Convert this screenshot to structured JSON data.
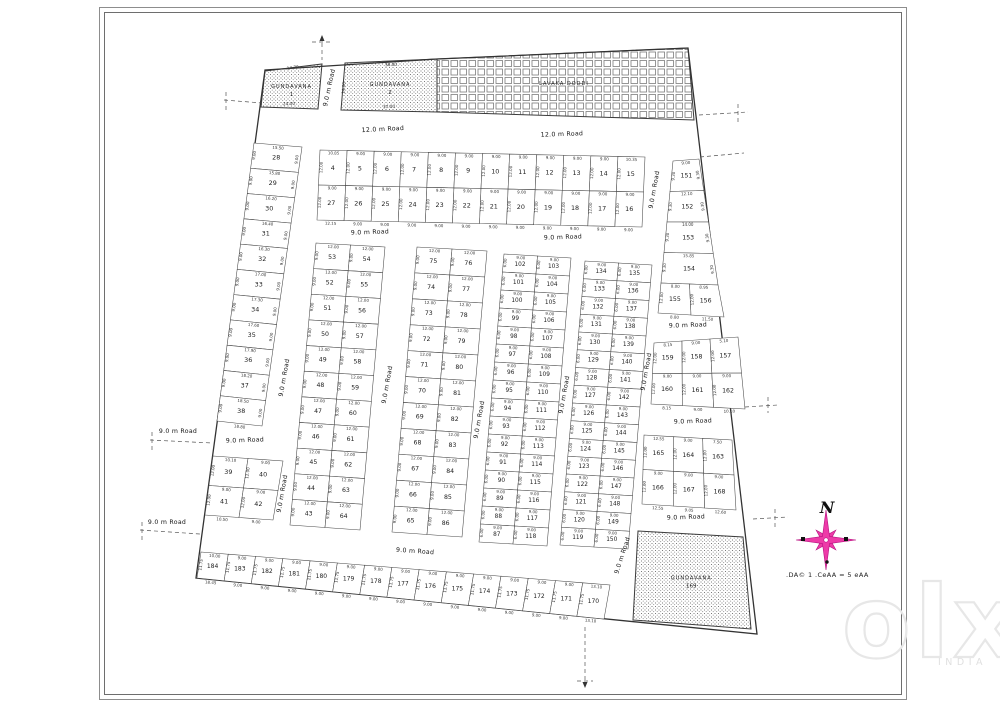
{
  "north": {
    "label": "N"
  },
  "scale_text": ".DA© 1  .CeAA = 5 eAA",
  "watermark": {
    "brand": "olx",
    "region": "INDIA"
  },
  "layout": {
    "boundary": [
      [
        265,
        70
      ],
      [
        437,
        59
      ],
      [
        688,
        48
      ],
      [
        757,
        634
      ],
      [
        196,
        578
      ]
    ],
    "special_areas": [
      {
        "name": "area-gundavana-1",
        "label": "GUNDAVANA",
        "number": "1",
        "pattern": "stipple",
        "poly": [
          [
            265,
            71
          ],
          [
            322,
            64
          ],
          [
            318,
            109
          ],
          [
            261,
            107
          ]
        ],
        "dims": [
          {
            "t": "14.70",
            "x": 293,
            "y": 69,
            "r": -7
          },
          {
            "t": "24.00",
            "x": 289,
            "y": 105,
            "r": -2
          }
        ]
      },
      {
        "name": "area-gundavana-2",
        "label": "GUNDAVANA",
        "number": "2",
        "pattern": "stipple",
        "poly": [
          [
            345,
            63
          ],
          [
            437,
            59
          ],
          [
            437,
            112
          ],
          [
            341,
            110
          ]
        ],
        "dims": [
          {
            "t": "36.00",
            "x": 391,
            "y": 66,
            "r": -2
          },
          {
            "t": "37.00",
            "x": 389,
            "y": 108,
            "r": -2
          },
          {
            "t": "14.00",
            "x": 345,
            "y": 88,
            "r": -85
          }
        ]
      },
      {
        "name": "area-lavaka-doddi",
        "label": "LAVAKA DODDI",
        "number": "",
        "pattern": "gridhatch",
        "poly": [
          [
            437,
            59
          ],
          [
            688,
            48
          ],
          [
            694,
            120
          ],
          [
            437,
            112
          ]
        ],
        "dims": []
      },
      {
        "name": "area-gundavana-169",
        "label": "GUNDAVANA",
        "number": "169",
        "pattern": "stipple",
        "poly": [
          [
            638,
            531
          ],
          [
            743,
            537
          ],
          [
            751,
            629
          ],
          [
            633,
            620
          ]
        ],
        "dims": []
      }
    ],
    "blocks": [
      {
        "name": "block-4-27",
        "quad": [
          [
            320,
            150
          ],
          [
            645,
            157
          ],
          [
            642,
            227
          ],
          [
            317,
            220
          ]
        ],
        "rows": 2,
        "cols": 12,
        "fs": 6.4,
        "nums": [
          [
            4,
            5,
            6,
            7,
            8,
            9,
            10,
            11,
            12,
            13,
            14,
            15
          ],
          [
            27,
            26,
            25,
            24,
            23,
            22,
            21,
            20,
            19,
            18,
            17,
            16
          ]
        ],
        "wdim": "9.00",
        "ddim": "12.00",
        "top_dims": [
          "10.85",
          "9.00",
          "9.00",
          "9.00",
          "9.00",
          "9.00",
          "9.00",
          "9.00",
          "9.00",
          "9.00",
          "9.00",
          "10.35"
        ],
        "bottom_dims": [
          "12.15",
          "9.00",
          "9.00",
          "9.00",
          "9.00",
          "9.00",
          "9.00",
          "9.00",
          "9.00",
          "9.00",
          "9.00",
          "9.00"
        ]
      },
      {
        "name": "block-28-38",
        "quad": [
          [
            254,
            143
          ],
          [
            302,
            147
          ],
          [
            262,
            426
          ],
          [
            217,
            421
          ]
        ],
        "rows": 11,
        "cols": 1,
        "fs": 6.4,
        "nums": [
          [
            28
          ],
          [
            29
          ],
          [
            30
          ],
          [
            31
          ],
          [
            32
          ],
          [
            33
          ],
          [
            34
          ],
          [
            35
          ],
          [
            36
          ],
          [
            37
          ],
          [
            38
          ]
        ],
        "ddim": "9.00",
        "ddim_right": "9.00",
        "row_dims": [
          "15.50",
          "15.80",
          "16.20",
          "16.40",
          "16.30",
          "17.00",
          "17.30",
          "17.60",
          "17.90",
          "18.20",
          "18.50"
        ],
        "bottom_dims": [
          "18.80"
        ]
      },
      {
        "name": "block-39-42",
        "quad": [
          [
            213,
            456
          ],
          [
            283,
            461
          ],
          [
            273,
            520
          ],
          [
            205,
            515
          ]
        ],
        "rows": 2,
        "cols": 2,
        "fs": 6.4,
        "nums": [
          [
            39,
            40
          ],
          [
            41,
            42
          ]
        ],
        "wdim": "9.00",
        "ddim": "12.00",
        "top_dims": [
          "10.10",
          "9.00"
        ],
        "bottom_dims": [
          "10.50",
          "9.00"
        ]
      },
      {
        "name": "block-43-64",
        "quad": [
          [
            316,
            243
          ],
          [
            385,
            247
          ],
          [
            360,
            530
          ],
          [
            290,
            525
          ]
        ],
        "rows": 11,
        "cols": 2,
        "fs": 6.2,
        "nums": [
          [
            53,
            54
          ],
          [
            52,
            55
          ],
          [
            51,
            56
          ],
          [
            50,
            57
          ],
          [
            49,
            58
          ],
          [
            48,
            59
          ],
          [
            47,
            60
          ],
          [
            46,
            61
          ],
          [
            45,
            62
          ],
          [
            44,
            63
          ],
          [
            43,
            64
          ]
        ],
        "wdim": "12.00",
        "ddim": "9.00"
      },
      {
        "name": "block-65-86",
        "quad": [
          [
            417,
            247
          ],
          [
            487,
            251
          ],
          [
            462,
            537
          ],
          [
            392,
            532
          ]
        ],
        "rows": 11,
        "cols": 2,
        "fs": 6.2,
        "nums": [
          [
            75,
            76
          ],
          [
            74,
            77
          ],
          [
            73,
            78
          ],
          [
            72,
            79
          ],
          [
            71,
            80
          ],
          [
            70,
            81
          ],
          [
            69,
            82
          ],
          [
            68,
            83
          ],
          [
            67,
            84
          ],
          [
            66,
            85
          ],
          [
            65,
            86
          ]
        ],
        "wdim": "12.00",
        "ddim": "9.00"
      },
      {
        "name": "block-87-118",
        "quad": [
          [
            504,
            254
          ],
          [
            571,
            258
          ],
          [
            547,
            546
          ],
          [
            479,
            542
          ]
        ],
        "rows": 16,
        "cols": 2,
        "fs": 5.8,
        "nums": [
          [
            102,
            103
          ],
          [
            101,
            104
          ],
          [
            100,
            105
          ],
          [
            99,
            106
          ],
          [
            98,
            107
          ],
          [
            97,
            108
          ],
          [
            96,
            109
          ],
          [
            95,
            110
          ],
          [
            94,
            111
          ],
          [
            93,
            112
          ],
          [
            92,
            113
          ],
          [
            91,
            114
          ],
          [
            90,
            115
          ],
          [
            89,
            116
          ],
          [
            88,
            117
          ],
          [
            87,
            118
          ]
        ],
        "wdim": "9.00",
        "ddim": "6.00"
      },
      {
        "name": "block-119-150",
        "quad": [
          [
            585,
            261
          ],
          [
            652,
            265
          ],
          [
            628,
            549
          ],
          [
            560,
            545
          ]
        ],
        "rows": 16,
        "cols": 2,
        "fs": 5.8,
        "nums": [
          [
            134,
            135
          ],
          [
            133,
            136
          ],
          [
            132,
            137
          ],
          [
            131,
            138
          ],
          [
            130,
            139
          ],
          [
            129,
            140
          ],
          [
            128,
            141
          ],
          [
            127,
            142
          ],
          [
            126,
            143
          ],
          [
            125,
            144
          ],
          [
            124,
            145
          ],
          [
            123,
            146
          ],
          [
            122,
            147
          ],
          [
            121,
            148
          ],
          [
            120,
            149
          ],
          [
            119,
            150
          ]
        ],
        "wdim": "9.00",
        "ddim": "6.00"
      },
      {
        "name": "block-151-154",
        "quad": [
          [
            673,
            161
          ],
          [
            699,
            159
          ],
          [
            718,
            285
          ],
          [
            661,
            283
          ]
        ],
        "rows": 4,
        "cols": 1,
        "fs": 6.2,
        "nums": [
          [
            151
          ],
          [
            152
          ],
          [
            153
          ],
          [
            154
          ]
        ],
        "ddim": "9.30",
        "ddim_right": "9.30",
        "row_dims": [
          "9.00",
          "12.10",
          "14.00",
          "15.85"
        ],
        "bottom_dims": [
          "17.75"
        ]
      },
      {
        "name": "block-155-156",
        "quad": [
          [
            661,
            283
          ],
          [
            718,
            285
          ],
          [
            724,
            317
          ],
          [
            658,
            313
          ]
        ],
        "rows": 1,
        "cols": 2,
        "fs": 6.2,
        "nums": [
          [
            155,
            156
          ]
        ],
        "ddim": "12.00",
        "top_dims": [
          "8.00",
          "8.95"
        ],
        "bottom_dims": [
          "8.80",
          "11.50"
        ]
      },
      {
        "name": "block-157-162",
        "quad": [
          [
            654,
            343
          ],
          [
            738,
            337
          ],
          [
            745,
            409
          ],
          [
            651,
            404
          ]
        ],
        "rows": 2,
        "cols": 3,
        "fs": 6.2,
        "nums": [
          [
            159,
            158,
            157
          ],
          [
            160,
            161,
            162
          ]
        ],
        "wdim": "9.00",
        "ddim": "12.00",
        "top_dims": [
          "8.15",
          "9.00",
          "5.10"
        ],
        "bottom_dims": [
          "8.15",
          "9.00",
          "10.10"
        ]
      },
      {
        "name": "block-163-168",
        "quad": [
          [
            644,
            435
          ],
          [
            732,
            440
          ],
          [
            736,
            510
          ],
          [
            642,
            504
          ]
        ],
        "rows": 2,
        "cols": 3,
        "fs": 6.2,
        "nums": [
          [
            165,
            164,
            163
          ],
          [
            166,
            167,
            168
          ]
        ],
        "wdim": "9.00",
        "ddim": "12.00",
        "top_dims": [
          "12.55",
          "9.00",
          "7.50"
        ],
        "bottom_dims": [
          "12.55",
          "9.05",
          "12.60"
        ]
      },
      {
        "name": "block-170-184",
        "quad": [
          [
            201,
            552
          ],
          [
            610,
            585
          ],
          [
            604,
            619
          ],
          [
            197,
            578
          ]
        ],
        "rows": 1,
        "cols": 15,
        "fs": 6.0,
        "nums": [
          [
            184,
            183,
            182,
            181,
            180,
            179,
            178,
            177,
            176,
            175,
            174,
            173,
            172,
            171,
            170
          ]
        ],
        "wdim": "9.00",
        "ddim": "11.75",
        "top_dims": [
          "10.00",
          "9.00",
          "9.00",
          "9.00",
          "9.00",
          "9.00",
          "9.00",
          "9.00",
          "9.00",
          "9.00",
          "9.00",
          "9.00",
          "9.00",
          "9.00",
          "13.10"
        ],
        "bottom_dims": [
          "18.45",
          "9.00",
          "9.00",
          "9.00",
          "9.00",
          "9.00",
          "9.00",
          "9.00",
          "9.00",
          "9.00",
          "9.00",
          "9.00",
          "9.00",
          "9.00",
          "13.10"
        ]
      }
    ],
    "roads": [
      {
        "t": "12.0 m Road",
        "x": 383,
        "y": 131,
        "r": -3
      },
      {
        "t": "12.0 m Road",
        "x": 562,
        "y": 136,
        "r": -2
      },
      {
        "t": "9.0 m Road",
        "x": 331,
        "y": 88,
        "r": -78
      },
      {
        "t": "9.0 m Road",
        "x": 370,
        "y": 234,
        "r": -2
      },
      {
        "t": "9.0 m Road",
        "x": 563,
        "y": 239,
        "r": -2
      },
      {
        "t": "9.0 m Road",
        "x": 656,
        "y": 190,
        "r": -80
      },
      {
        "t": "9.0 m Road",
        "x": 286,
        "y": 378,
        "r": -80
      },
      {
        "t": "9.0 m Road",
        "x": 284,
        "y": 494,
        "r": -80
      },
      {
        "t": "9.0 m Road",
        "x": 389,
        "y": 385,
        "r": -80
      },
      {
        "t": "9.0 m Road",
        "x": 481,
        "y": 420,
        "r": -80
      },
      {
        "t": "9.0 m Road",
        "x": 566,
        "y": 395,
        "r": -80
      },
      {
        "t": "9.0 m Road",
        "x": 648,
        "y": 372,
        "r": -80
      },
      {
        "t": "9.0 m Road",
        "x": 624,
        "y": 556,
        "r": -72
      },
      {
        "t": "9.0 m Road",
        "x": 688,
        "y": 327,
        "r": -2
      },
      {
        "t": "9.0 m Road",
        "x": 693,
        "y": 423,
        "r": -2
      },
      {
        "t": "9.0 m Road",
        "x": 686,
        "y": 519,
        "r": -2
      },
      {
        "t": "9.0 m Road",
        "x": 245,
        "y": 442,
        "r": -2
      },
      {
        "t": "9.0 m Road",
        "x": 178,
        "y": 433,
        "r": 0
      },
      {
        "t": "9.0 m Road",
        "x": 167,
        "y": 524,
        "r": 0
      },
      {
        "t": "9.0 m Road",
        "x": 415,
        "y": 553,
        "r": 4
      }
    ],
    "dashes": [
      {
        "x1": 322,
        "y1": 36,
        "x2": 322,
        "y2": 60
      },
      {
        "x1": 312,
        "y1": 42,
        "x2": 332,
        "y2": 42
      },
      {
        "x1": 224,
        "y1": 100,
        "x2": 262,
        "y2": 103
      },
      {
        "x1": 226,
        "y1": 92,
        "x2": 226,
        "y2": 110
      },
      {
        "x1": 150,
        "y1": 440,
        "x2": 212,
        "y2": 443
      },
      {
        "x1": 152,
        "y1": 432,
        "x2": 152,
        "y2": 450
      },
      {
        "x1": 140,
        "y1": 530,
        "x2": 200,
        "y2": 534
      },
      {
        "x1": 142,
        "y1": 522,
        "x2": 142,
        "y2": 540
      },
      {
        "x1": 699,
        "y1": 115,
        "x2": 748,
        "y2": 112
      },
      {
        "x1": 738,
        "y1": 104,
        "x2": 738,
        "y2": 122
      },
      {
        "x1": 700,
        "y1": 157,
        "x2": 744,
        "y2": 153
      },
      {
        "x1": 745,
        "y1": 407,
        "x2": 778,
        "y2": 405
      },
      {
        "x1": 768,
        "y1": 397,
        "x2": 768,
        "y2": 413
      },
      {
        "x1": 753,
        "y1": 519,
        "x2": 788,
        "y2": 517
      },
      {
        "x1": 775,
        "y1": 509,
        "x2": 775,
        "y2": 527
      },
      {
        "x1": 585,
        "y1": 627,
        "x2": 585,
        "y2": 686
      },
      {
        "x1": 577,
        "y1": 681,
        "x2": 593,
        "y2": 681
      }
    ],
    "compass": {
      "cx": 826,
      "cy": 540,
      "color": "#ee3aa8",
      "edge": "#b51380"
    }
  }
}
